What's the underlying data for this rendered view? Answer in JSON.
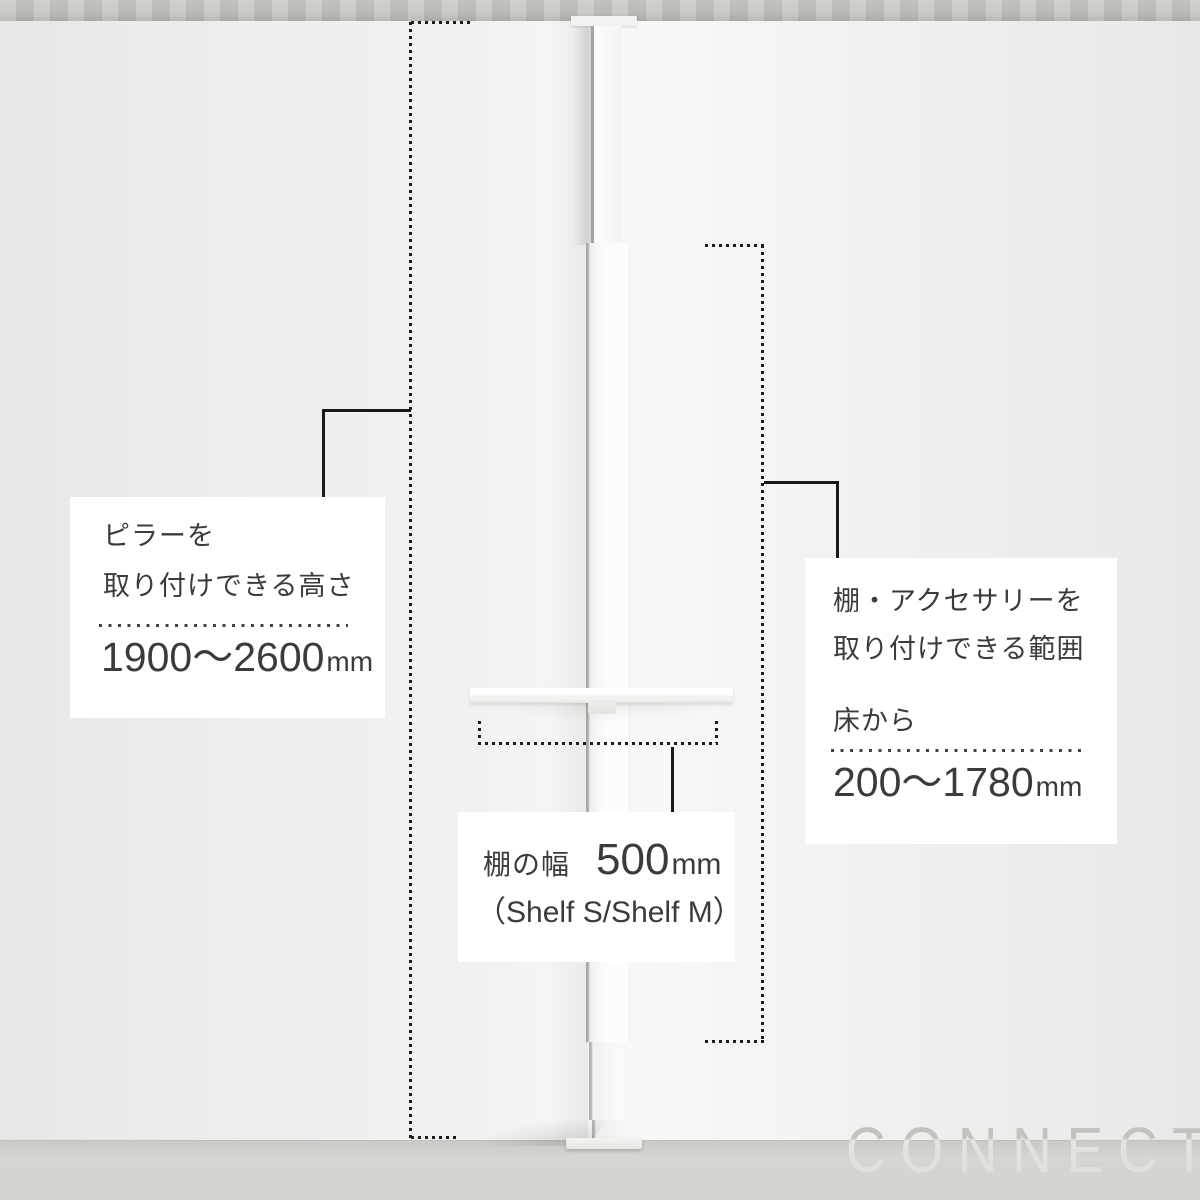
{
  "scene": {
    "description": "Tension pole wall-shelf product measurement diagram over studio photo"
  },
  "watermark": {
    "text": "CONNECT"
  },
  "callouts": {
    "pillar_height": {
      "line1": "ピラーを",
      "line2": "取り付けできる高さ",
      "value": "1900〜2600",
      "unit": "mm"
    },
    "mount_range": {
      "line1": "棚・アクセサリーを",
      "line2": "取り付けできる範囲",
      "prefix": "床から",
      "value": "200〜1780",
      "unit": "mm"
    },
    "shelf_width": {
      "label": "棚の幅",
      "value": "500",
      "unit": "mm",
      "note": "（Shelf S/Shelf M）"
    }
  },
  "colors": {
    "wall": "#f1f1f0",
    "ceiling": "#c6c6c2",
    "floor": "#d3d3d0",
    "callout_background": "#ffffff",
    "text": "#3b3b3b",
    "measure_line": "#1c1c1c",
    "watermark": "#c5c5c2"
  }
}
